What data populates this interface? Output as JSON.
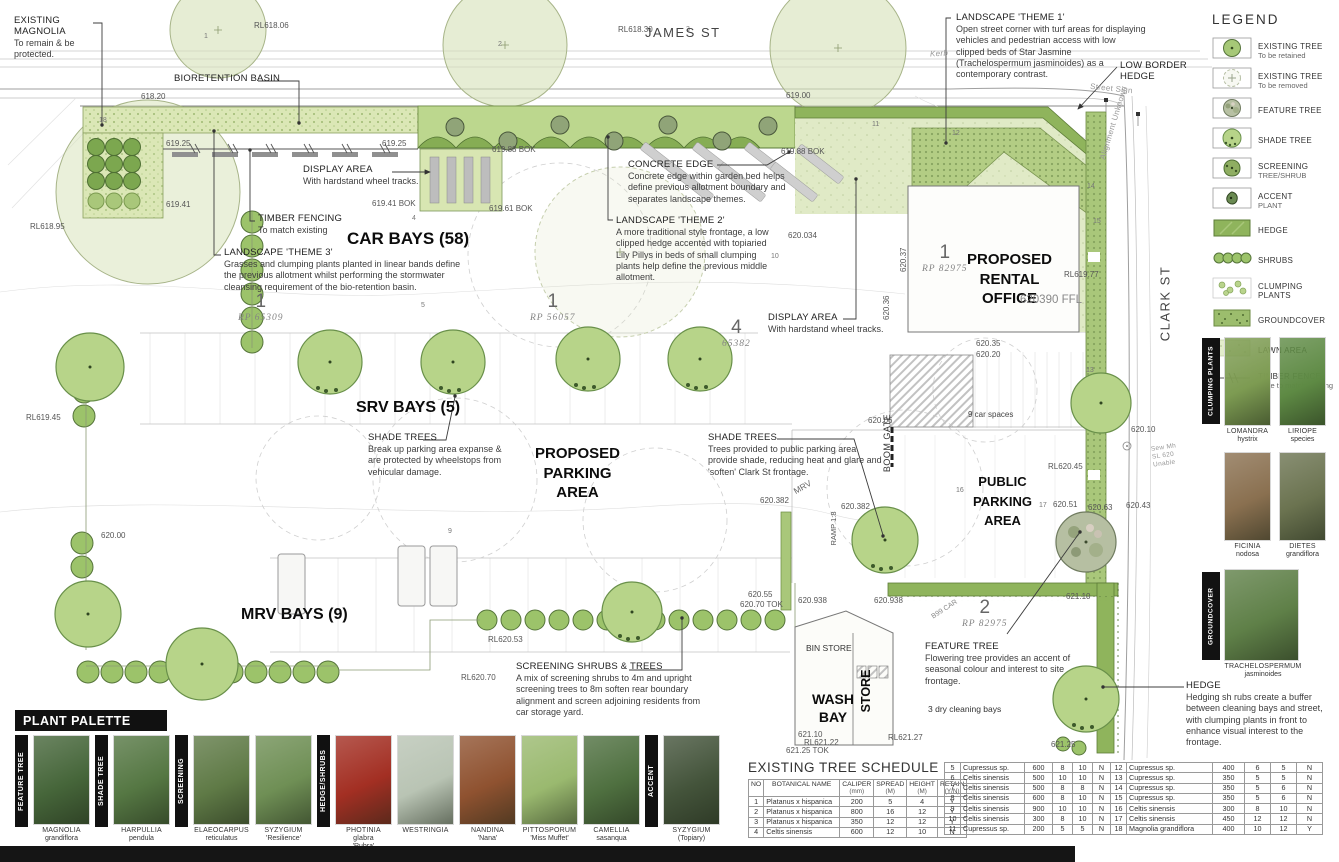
{
  "streets": {
    "james": "JAMES ST",
    "clark": "CLARK ST",
    "kerb": "Kerb",
    "street_sign": "Street Sign",
    "alignment": "Alignment Unknown",
    "sew_note": "Sew Mh\nSL 620\nUnable"
  },
  "areas": {
    "car_bays": "CAR BAYS (58)",
    "srv_bays": "SRV BAYS (5)",
    "mrv_bays": "MRV BAYS (9)",
    "proposed_parking": "PROPOSED\nPARKING\nAREA",
    "rental_office": "PROPOSED\nRENTAL\nOFFICE",
    "rental_office_ffl": "620390 FFL",
    "public_parking": "PUBLIC\nPARKING\nAREA",
    "wash_bay": "WASH\nBAY",
    "store": "STORE",
    "bin_store": "BIN STORE",
    "dry_cleaning_bays": "3 dry cleaning bays",
    "car_spaces": "9 car spaces",
    "boom_gate": "BOOM GATE",
    "ramp": "RAMP 1:8",
    "mrv": "MRV",
    "b99": "B99 CAR"
  },
  "callouts": {
    "existing_magnolia": {
      "title": "EXISTING MAGNOLIA",
      "body": "To remain & be protected."
    },
    "bioretention": {
      "title": "BIORETENTION BASIN",
      "body": ""
    },
    "display_area_1": {
      "title": "DISPLAY AREA",
      "body": "With hardstand wheel tracks."
    },
    "timber_fencing": {
      "title": "TIMBER FENCING",
      "body": "To match existing"
    },
    "theme3": {
      "title": "LANDSCAPE 'THEME 3'",
      "body": "Grasses and clumping plants planted in linear bands define the previous allotment whilst performing the stormwater cleansing requirement of the bio-retention basin."
    },
    "concrete_edge": {
      "title": "CONCRETE EDGE",
      "body": "Concrete edge within garden bed helps define previous allotment boundary and separates landscape themes."
    },
    "theme2": {
      "title": "LANDSCAPE 'THEME 2'",
      "body": "A more traditional style frontage, a low clipped hedge accented with topiaried Lily Pillys in beds of small clumping plants help define the previous middle allotment."
    },
    "theme1": {
      "title": "LANDSCAPE 'THEME 1'",
      "body": "Open street corner with turf areas for displaying vehicles and pedestrian access with low clipped beds of Star Jasmine (Trachelospermum jasminoides) as a contemporary contrast."
    },
    "low_border_hedge": {
      "title": "LOW BORDER HEDGE",
      "body": ""
    },
    "display_area_2": {
      "title": "DISPLAY AREA",
      "body": "With hardstand wheel tracks."
    },
    "shade_trees_1": {
      "title": "SHADE TREES",
      "body": "Break up parking area expanse & are protected by wheelstops from vehicular damage."
    },
    "shade_trees_2": {
      "title": "SHADE TREES",
      "body": "Trees provided to public parking area provide shade, reducing heat and glare and 'soften' Clark St frontage."
    },
    "screening_shrubs": {
      "title": "SCREENING SHRUBS & TREES",
      "body": "A mix of screening shrubs to 4m and upright screening trees to 8m soften rear boundary alignment and screen adjoining residents from car storage yard."
    },
    "feature_tree": {
      "title": "FEATURE TREE",
      "body": "Flowering tree provides an accent of seasonal colour and interest to site frontage."
    },
    "hedge": {
      "title": "HEDGE",
      "body": "Hedging sh rubs create a buffer between cleaning bays and street, with clumping plants in front to enhance visual interest to the frontage."
    }
  },
  "lots": [
    {
      "num": "1",
      "rp": "RP 65309",
      "x": 238,
      "y": 292
    },
    {
      "num": "1",
      "rp": "RP 56057",
      "x": 530,
      "y": 292
    },
    {
      "num": "4",
      "rp": "65382",
      "x": 722,
      "y": 318
    },
    {
      "num": "1",
      "rp": "RP 82975",
      "x": 922,
      "y": 243
    },
    {
      "num": "2",
      "rp": "RP 82975",
      "x": 962,
      "y": 598
    }
  ],
  "levels": [
    {
      "t": "RL618.06",
      "x": 254,
      "y": 21
    },
    {
      "t": "RL618.30",
      "x": 618,
      "y": 25
    },
    {
      "t": "618.20",
      "x": 141,
      "y": 92
    },
    {
      "t": "619.00",
      "x": 786,
      "y": 91
    },
    {
      "t": "619.25",
      "x": 166,
      "y": 139
    },
    {
      "t": "619.25",
      "x": 382,
      "y": 139
    },
    {
      "t": "619.88 BOK",
      "x": 492,
      "y": 145
    },
    {
      "t": "619.88 BOK",
      "x": 781,
      "y": 147
    },
    {
      "t": "619.41",
      "x": 166,
      "y": 200
    },
    {
      "t": "619.41 BOK",
      "x": 372,
      "y": 199
    },
    {
      "t": "619.61 BOK",
      "x": 489,
      "y": 204
    },
    {
      "t": "RL618.95",
      "x": 30,
      "y": 222
    },
    {
      "t": "620.034",
      "x": 788,
      "y": 231
    },
    {
      "t": "620.37",
      "x": 899,
      "y": 272,
      "r": -90
    },
    {
      "t": "620.36",
      "x": 882,
      "y": 320,
      "r": -90
    },
    {
      "t": "RL619.77",
      "x": 1064,
      "y": 270
    },
    {
      "t": "620.35",
      "x": 976,
      "y": 339
    },
    {
      "t": "620.20",
      "x": 976,
      "y": 350
    },
    {
      "t": "620.06",
      "x": 868,
      "y": 416
    },
    {
      "t": "RL620.45",
      "x": 1048,
      "y": 462
    },
    {
      "t": "620.51",
      "x": 1053,
      "y": 500
    },
    {
      "t": "620.63",
      "x": 1088,
      "y": 503
    },
    {
      "t": "620.43",
      "x": 1126,
      "y": 501
    },
    {
      "t": "RL619.45",
      "x": 26,
      "y": 413
    },
    {
      "t": "620.00",
      "x": 101,
      "y": 531
    },
    {
      "t": "620.382",
      "x": 760,
      "y": 496
    },
    {
      "t": "620.382",
      "x": 841,
      "y": 502
    },
    {
      "t": "620.55",
      "x": 748,
      "y": 590
    },
    {
      "t": "620.70 TOK",
      "x": 740,
      "y": 600
    },
    {
      "t": "620.938",
      "x": 798,
      "y": 596
    },
    {
      "t": "620.938",
      "x": 874,
      "y": 596
    },
    {
      "t": "621.10",
      "x": 1066,
      "y": 592
    },
    {
      "t": "RL620.53",
      "x": 488,
      "y": 635
    },
    {
      "t": "RL620.70",
      "x": 461,
      "y": 673
    },
    {
      "t": "621.10",
      "x": 798,
      "y": 730
    },
    {
      "t": "RL621.22",
      "x": 804,
      "y": 738
    },
    {
      "t": "621.25 TOK",
      "x": 786,
      "y": 746
    },
    {
      "t": "RL621.27",
      "x": 888,
      "y": 733
    },
    {
      "t": "621.25",
      "x": 1051,
      "y": 740
    },
    {
      "t": "620.10",
      "x": 1131,
      "y": 425
    }
  ],
  "markers": [
    {
      "n": "1",
      "x": 204,
      "y": 33
    },
    {
      "n": "2",
      "x": 498,
      "y": 41
    },
    {
      "n": "3",
      "x": 686,
      "y": 26
    },
    {
      "n": "4",
      "x": 412,
      "y": 215
    },
    {
      "n": "5",
      "x": 421,
      "y": 302
    },
    {
      "n": "9",
      "x": 448,
      "y": 528
    },
    {
      "n": "10",
      "x": 771,
      "y": 253
    },
    {
      "n": "11",
      "x": 872,
      "y": 121
    },
    {
      "n": "12",
      "x": 952,
      "y": 130
    },
    {
      "n": "13",
      "x": 1086,
      "y": 367
    },
    {
      "n": "14",
      "x": 1087,
      "y": 183
    },
    {
      "n": "15",
      "x": 1093,
      "y": 218
    },
    {
      "n": "16",
      "x": 956,
      "y": 487
    },
    {
      "n": "17",
      "x": 1039,
      "y": 502
    },
    {
      "n": "18",
      "x": 99,
      "y": 117
    }
  ],
  "legend": {
    "title": "LEGEND",
    "items": [
      {
        "label": "EXISTING TREE",
        "sub": "To be retained",
        "swatch": "existing-retained"
      },
      {
        "label": "EXISTING TREE",
        "sub": "To be removed",
        "swatch": "existing-removed"
      },
      {
        "label": "FEATURE TREE",
        "sub": "",
        "swatch": "feature-tree"
      },
      {
        "label": "SHADE TREE",
        "sub": "",
        "swatch": "shade-tree"
      },
      {
        "label": "SCREENING",
        "sub": "TREE/SHRUB",
        "swatch": "screening-tree"
      },
      {
        "label": "ACCENT",
        "sub": "PLANT",
        "swatch": "accent-plant"
      },
      {
        "label": "HEDGE",
        "sub": "",
        "swatch": "hedge"
      },
      {
        "label": "SHRUBS",
        "sub": "",
        "swatch": "shrubs"
      },
      {
        "label": "CLUMPING PLANTS",
        "sub": "",
        "swatch": "clumping"
      },
      {
        "label": "GROUNDCOVER",
        "sub": "",
        "swatch": "groundcover"
      },
      {
        "label": "LAWN AREA",
        "sub": "",
        "swatch": "lawn"
      },
      {
        "label": "TIMBER FENCE",
        "sub": "Style to match existing",
        "swatch": "timber-fence"
      }
    ]
  },
  "sidebar_plants": {
    "clumping_title": "CLUMPING PLANTS",
    "clumping": [
      {
        "name": "LOMANDRA",
        "variety": "hystrix",
        "photo_color": "#7d9b52"
      },
      {
        "name": "LIRIOPE",
        "variety": "species",
        "photo_color": "#5e8a44"
      },
      {
        "name": "FICINIA",
        "variety": "nodosa",
        "photo_color": "#8a7050"
      },
      {
        "name": "DIETES",
        "variety": "grandiflora",
        "photo_color": "#6b7350"
      }
    ],
    "groundcover_title": "GROUNDCOVER",
    "groundcover": [
      {
        "name": "TRACHELOSPERMUM",
        "variety": "jasminoides",
        "photo_color": "#5f8048"
      }
    ]
  },
  "palette": {
    "title": "PLANT PALETTE",
    "groups": [
      {
        "category": "FEATURE TREE",
        "plants": [
          {
            "name": "MAGNOLIA",
            "variety": "grandiflora",
            "photo_color": "#46663a"
          }
        ]
      },
      {
        "category": "SHADE TREE",
        "plants": [
          {
            "name": "HARPULLIA",
            "variety": "pendula",
            "photo_color": "#557743"
          }
        ]
      },
      {
        "category": "SCREENING",
        "plants": [
          {
            "name": "ELAEOCARPUS",
            "variety": "reticulatus",
            "photo_color": "#5f7a46"
          },
          {
            "name": "SYZYGIUM",
            "variety": "'Resilience'",
            "photo_color": "#6f8f55"
          }
        ]
      },
      {
        "category": "HEDGE/SHRUBS",
        "plants": [
          {
            "name": "PHOTINIA glabra",
            "variety": "'Rubra'",
            "photo_color": "#a32f23"
          },
          {
            "name": "WESTRINGIA",
            "variety": "",
            "photo_color": "#b9c4b4"
          },
          {
            "name": "NANDINA",
            "variety": "'Nana'",
            "photo_color": "#8f5230"
          },
          {
            "name": "PITTOSPORUM",
            "variety": "'Miss Muffet'",
            "photo_color": "#9ab96f"
          },
          {
            "name": "CAMELLIA",
            "variety": "sasanqua",
            "photo_color": "#4f7040"
          }
        ]
      },
      {
        "category": "ACCENT",
        "plants": [
          {
            "name": "SYZYGIUM",
            "variety": "(Topiary)",
            "photo_color": "#44543b"
          }
        ]
      }
    ]
  },
  "schedule": {
    "title": "EXISTING TREE SCHEDULE",
    "headers": [
      [
        "NO",
        ""
      ],
      [
        "BOTANICAL NAME",
        ""
      ],
      [
        "CALIPER",
        "(mm)"
      ],
      [
        "SPREAD",
        "(M)"
      ],
      [
        "HEIGHT",
        "(M)"
      ],
      [
        "RETAIN",
        "(Y/N)"
      ]
    ],
    "rows": [
      [
        "1",
        "Platanus x hispanica",
        "200",
        "5",
        "4",
        "Y"
      ],
      [
        "2",
        "Platanus x hispanica",
        "800",
        "16",
        "12",
        "Y"
      ],
      [
        "3",
        "Platanus x hispanica",
        "350",
        "12",
        "12",
        "Y"
      ],
      [
        "4",
        "Celtis sinensis",
        "600",
        "12",
        "10",
        "N"
      ],
      [
        "5",
        "Cupressus sp.",
        "600",
        "8",
        "10",
        "N"
      ],
      [
        "6",
        "Celtis sinensis",
        "500",
        "10",
        "10",
        "N"
      ],
      [
        "7",
        "Celtis sinensis",
        "500",
        "8",
        "8",
        "N"
      ],
      [
        "8",
        "Celtis sinensis",
        "600",
        "8",
        "10",
        "N"
      ],
      [
        "9",
        "Celtis sinensis",
        "900",
        "10",
        "10",
        "N"
      ],
      [
        "10",
        "Celtis sinensis",
        "300",
        "8",
        "10",
        "N"
      ],
      [
        "11",
        "Cupressus sp.",
        "200",
        "5",
        "5",
        "N"
      ],
      [
        "12",
        "Cupressus sp.",
        "400",
        "6",
        "5",
        "N"
      ],
      [
        "13",
        "Cupressus sp.",
        "350",
        "5",
        "5",
        "N"
      ],
      [
        "14",
        "Cupressus sp.",
        "350",
        "5",
        "6",
        "N"
      ],
      [
        "15",
        "Cupressus sp.",
        "350",
        "5",
        "6",
        "N"
      ],
      [
        "16",
        "Celtis sinensis",
        "300",
        "8",
        "10",
        "N"
      ],
      [
        "17",
        "Celtis sinensis",
        "450",
        "12",
        "12",
        "N"
      ],
      [
        "18",
        "Magnolia grandiflora",
        "400",
        "10",
        "12",
        "Y"
      ]
    ]
  },
  "colors": {
    "hedge_green": "#8fb45c",
    "shade_tree_green": "#b7d489",
    "lawn_green": "#e0eac6",
    "panel_black": "#111111"
  }
}
